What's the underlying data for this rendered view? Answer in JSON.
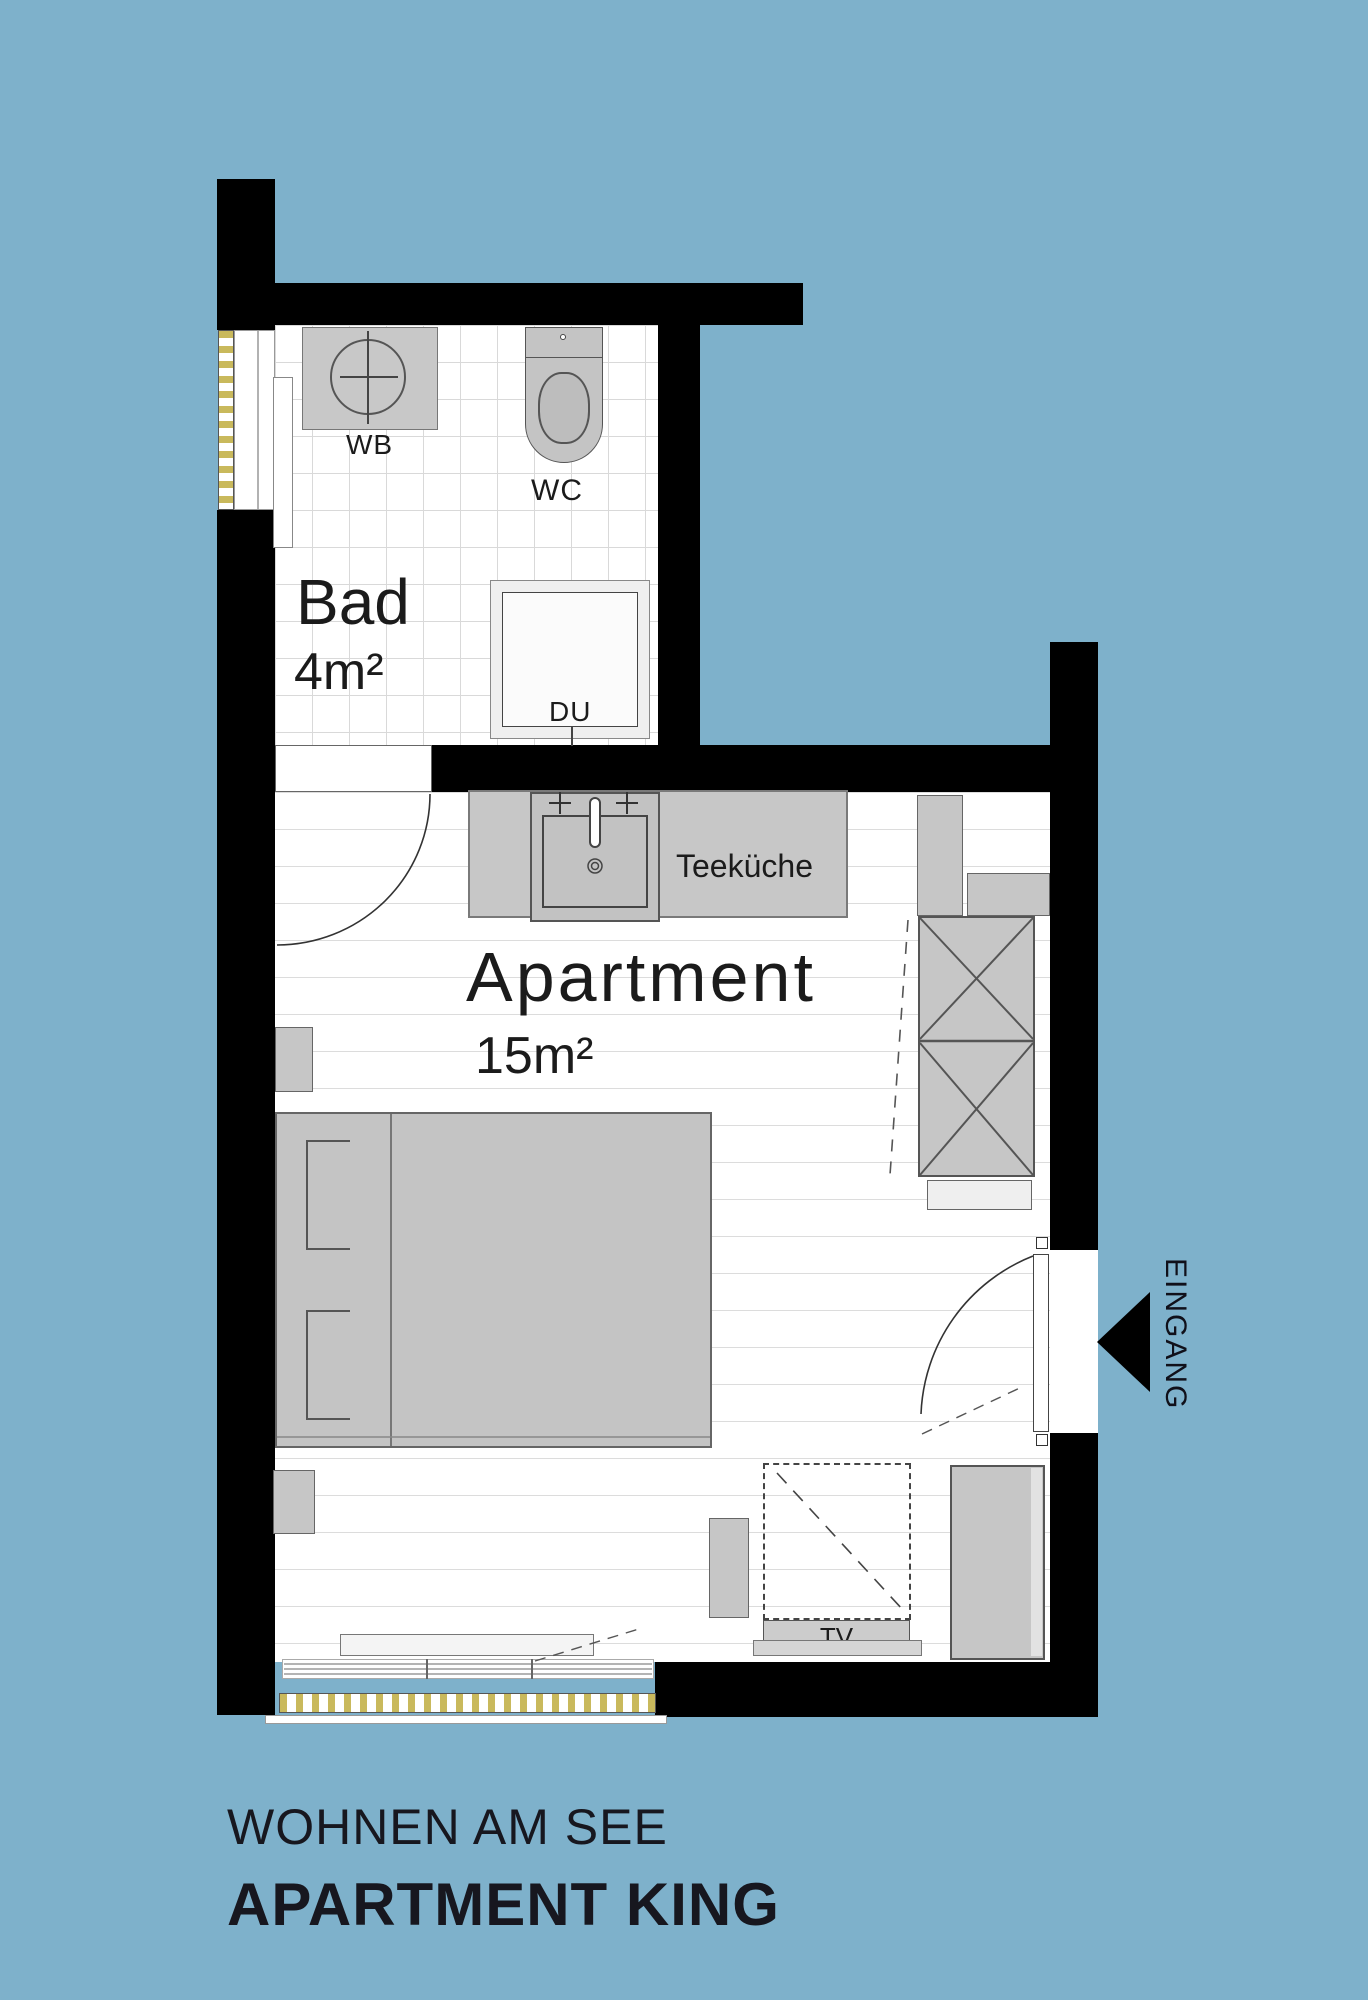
{
  "plan": {
    "rooms": {
      "bathroom": {
        "name": "Bad",
        "area": "4m²"
      },
      "apartment": {
        "name": "Apartment",
        "area": "15m²"
      },
      "kitchen": {
        "label": "Teeküche"
      }
    },
    "fixtures": {
      "washbasin": "WB",
      "toilet": "WC",
      "shower": "DU",
      "tv": "TV"
    },
    "entrance": {
      "label": "EINGANG",
      "arrow_icon": "left-arrow"
    },
    "footer": {
      "line1": "WOHNEN AM SEE",
      "line2": "APARTMENT KING"
    },
    "colors": {
      "background": "#7EB1CB",
      "walls": "#000000",
      "furniture": "#C6C6C6",
      "window_accent": "#C9B95C",
      "text": "#17171F"
    }
  }
}
